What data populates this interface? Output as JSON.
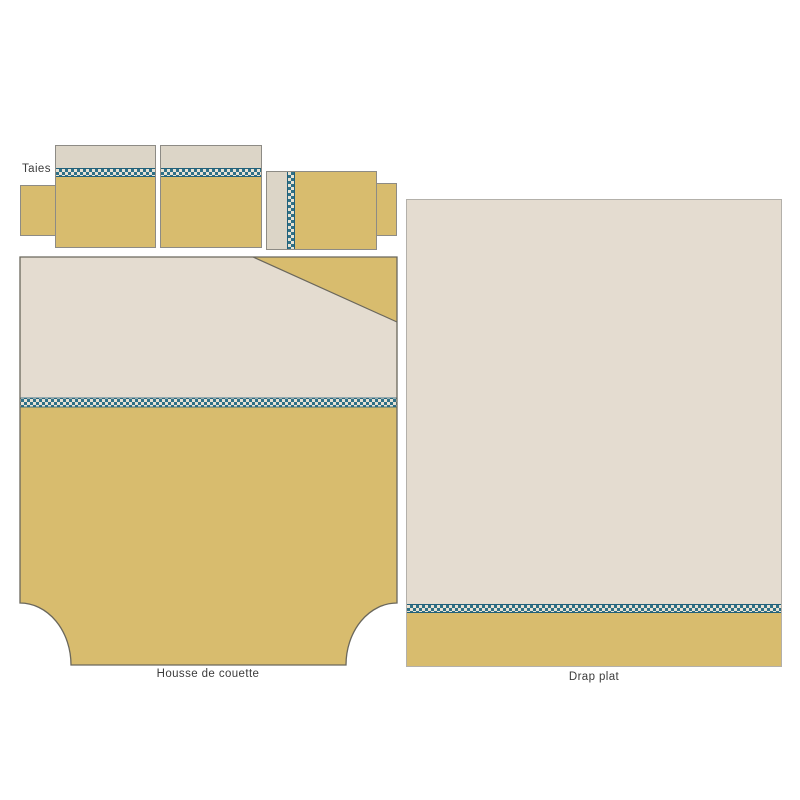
{
  "diagram": {
    "labels": {
      "pillowcases": "Taies",
      "duvet_cover": "Housse de couette",
      "flat_sheet": "Drap plat"
    },
    "colors": {
      "mustard": "#d8bc6e",
      "beige_panel": "#e4dcd0",
      "beige_strip": "#dcd5c7",
      "stitch_teal": "#2f7086",
      "stitch_ground": "#e8e2d4",
      "outline_dark": "#6a675c",
      "outline_medium": "#8d8b85",
      "outline_light": "#b3b0aa",
      "label_text": "#3b3b3b",
      "background": "#ffffff"
    }
  }
}
